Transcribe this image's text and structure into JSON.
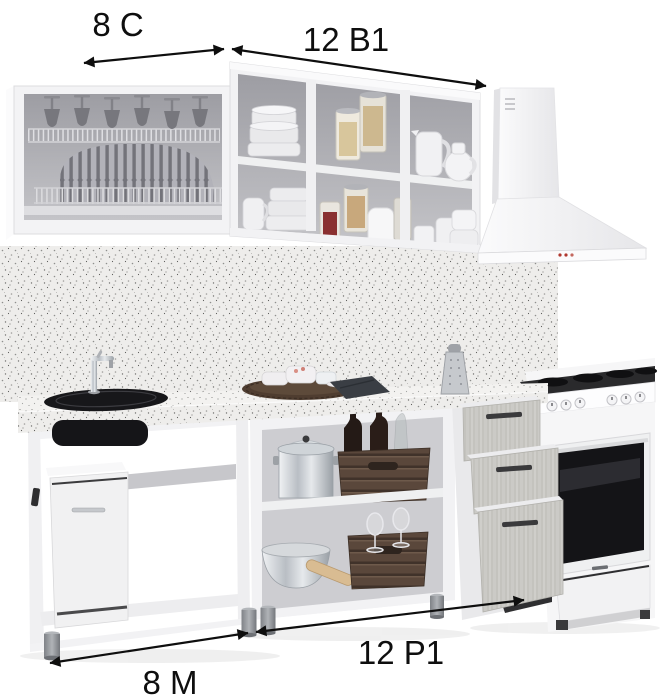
{
  "page": {
    "type": "kitchen-furniture-set-dimension-diagram",
    "background": "#ffffff"
  },
  "labels": {
    "wall_cabinet_left": "8 С",
    "wall_cabinet_right": "12 В1",
    "base_cabinet_right": "12 Р1",
    "base_cabinet_left": "8 М"
  },
  "colors": {
    "annotation": "#0e0e0e",
    "cabinet_white": "#f3f3f5",
    "cabinet_interior": "#aaaab0",
    "backsplash_speckle": "#eeedeb",
    "countertop_speckle": "#f3f2f0",
    "drawer_front_wood": "#cbcac6",
    "handle_dark": "#3a3a3c",
    "sink_black": "#17171a",
    "crate_wood": "#5a473b",
    "wine_bottle": "#261915",
    "metal_leg": "#8f9296",
    "hood_white": "#f8f8f9",
    "hood_indicator_red": "#b0372e",
    "oven_glass": "#141417"
  },
  "scene": {
    "modules": [
      {
        "name": "wall-cabinet-8C",
        "contents": [
          "wine-glasses",
          "wire-glass-rack",
          "plate-drying-rack"
        ]
      },
      {
        "name": "wall-cabinet-12B1",
        "contents": [
          "bowl-stacks",
          "food-jars",
          "pitchers",
          "cups"
        ]
      },
      {
        "name": "range-hood",
        "contents": [
          "chimney-duct",
          "indicator-lights"
        ]
      },
      {
        "name": "base-cabinet-8M",
        "contents": [
          "sink",
          "faucet",
          "waste-bin-cabinet"
        ]
      },
      {
        "name": "base-cabinet-12P1",
        "contents": [
          "stock-pot",
          "wine-crate",
          "wine-bottles",
          "metal-bowl",
          "wine-glasses",
          "rolling-pin"
        ]
      },
      {
        "name": "drawer-unit",
        "contents": [
          "drawer",
          "drawer",
          "drawer"
        ]
      },
      {
        "name": "electric-stove",
        "contents": [
          "cooktop-burners",
          "control-knobs",
          "oven-door",
          "storage-drawer"
        ]
      }
    ],
    "counter_items": [
      "wicker-tray-with-bowls",
      "kitchen-towel",
      "grater"
    ]
  }
}
